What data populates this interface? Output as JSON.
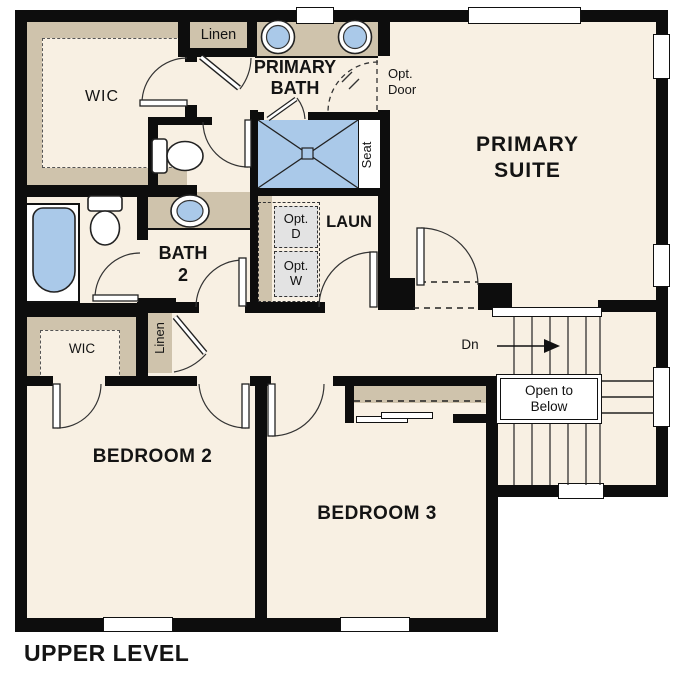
{
  "plan_title": "UPPER LEVEL",
  "rooms": {
    "primary_suite": "PRIMARY SUITE",
    "primary_bath": "PRIMARY BATH",
    "bath2": "BATH 2",
    "laundry": "LAUN",
    "bedroom2": "BEDROOM 2",
    "bedroom3": "BEDROOM 3",
    "wic_primary": "WIC",
    "wic_bedroom2": "WIC",
    "linen_upper": "Linen",
    "linen_hall": "Linen"
  },
  "annotations": {
    "seat": "Seat",
    "down": "Dn",
    "open_to_below": "Open to Below",
    "opt_door_l1": "Opt.",
    "opt_door_l2": "Door",
    "opt_dryer_l1": "Opt.",
    "opt_dryer_l2": "D",
    "opt_washer_l1": "Opt.",
    "opt_washer_l2": "W"
  },
  "colors": {
    "floor": "#f8f0e3",
    "wall": "#0d0d0d",
    "cabinet_tan": "#cfc3ac",
    "fixture_blue": "#aac9e9",
    "optional_gray": "#e3e3e3",
    "outside": "#ffffff"
  }
}
